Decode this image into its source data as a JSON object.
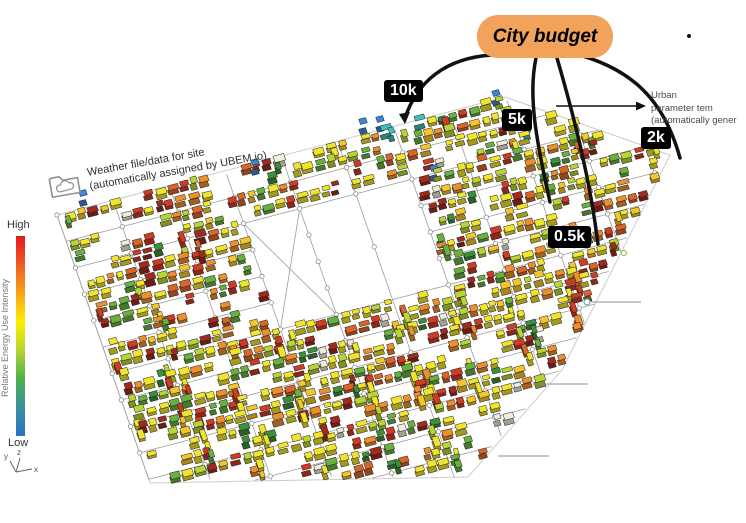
{
  "annotations": {
    "city_budget": {
      "label": "City budget",
      "fill": "#F1A35B",
      "text_color": "#000000"
    },
    "tags": [
      {
        "id": "10k",
        "label": "10k"
      },
      {
        "id": "5k",
        "label": "5k"
      },
      {
        "id": "2k",
        "label": "2k"
      },
      {
        "id": "05k",
        "label": "0.5k"
      }
    ],
    "urban_note": {
      "line1": "Urban",
      "line2": "parameter tem",
      "line3": "(automatically gener"
    },
    "weather_note": {
      "line1": "Weather file/data for site",
      "line2": "(automatically assigned by UBEM.io)"
    }
  },
  "legend": {
    "high_label": "High",
    "low_label": "Low",
    "title": "Relative Energy Use Intensity",
    "gradient": [
      "#e01b1d",
      "#ef5b24",
      "#f9a21a",
      "#fdf000",
      "#b8d433",
      "#4caf48",
      "#3b8fa0",
      "#2e72c4"
    ]
  },
  "axis": {
    "y": "y",
    "z": "z",
    "x": "x"
  },
  "map": {
    "seed": 12,
    "origin": [
      57,
      215
    ],
    "u": [
      0.967,
      -0.255
    ],
    "v": [
      0.328,
      0.944
    ],
    "boundary": [
      [
        57,
        215
      ],
      [
        505,
        97
      ],
      [
        670,
        155
      ],
      [
        562,
        370
      ],
      [
        468,
        477
      ],
      [
        150,
        483
      ]
    ],
    "a_spacing": 58,
    "b_spacing": 28,
    "a_max": 640,
    "b_max": 366,
    "empty_zone": {
      "a0": 172,
      "a1": 350,
      "b0": 54,
      "b1": 170
    },
    "x_block": {
      "a0": 174,
      "a1": 232,
      "b0": 56,
      "b1": 168
    },
    "street_color": "#9c9c9c",
    "boundary_color": "#cccccc",
    "node_fill": "#ffffff",
    "node_stroke": "#8f8f8f",
    "outline_color": "#1c1c1c",
    "palette": [
      [
        "#f0e42f",
        30
      ],
      [
        "#f3c72c",
        8
      ],
      [
        "#ee8f2e",
        13
      ],
      [
        "#d96527",
        6
      ],
      [
        "#cf3b23",
        13
      ],
      [
        "#9e2b1e",
        7
      ],
      [
        "#69b03f",
        9
      ],
      [
        "#b9d435",
        8
      ],
      [
        "#3d8f3a",
        4
      ],
      [
        "#f0edda",
        2
      ]
    ],
    "teal": "#3ec1b6",
    "blue": "#3a87d9",
    "teal_clusters": [
      [
        405,
        122,
        26
      ],
      [
        532,
        112,
        34
      ],
      [
        562,
        103,
        26
      ]
    ],
    "blue_buildings": [
      [
        83,
        203
      ],
      [
        255,
        172
      ],
      [
        363,
        131
      ],
      [
        380,
        129
      ],
      [
        496,
        103
      ],
      [
        434,
        178
      ]
    ],
    "side_shade": 0.68
  }
}
